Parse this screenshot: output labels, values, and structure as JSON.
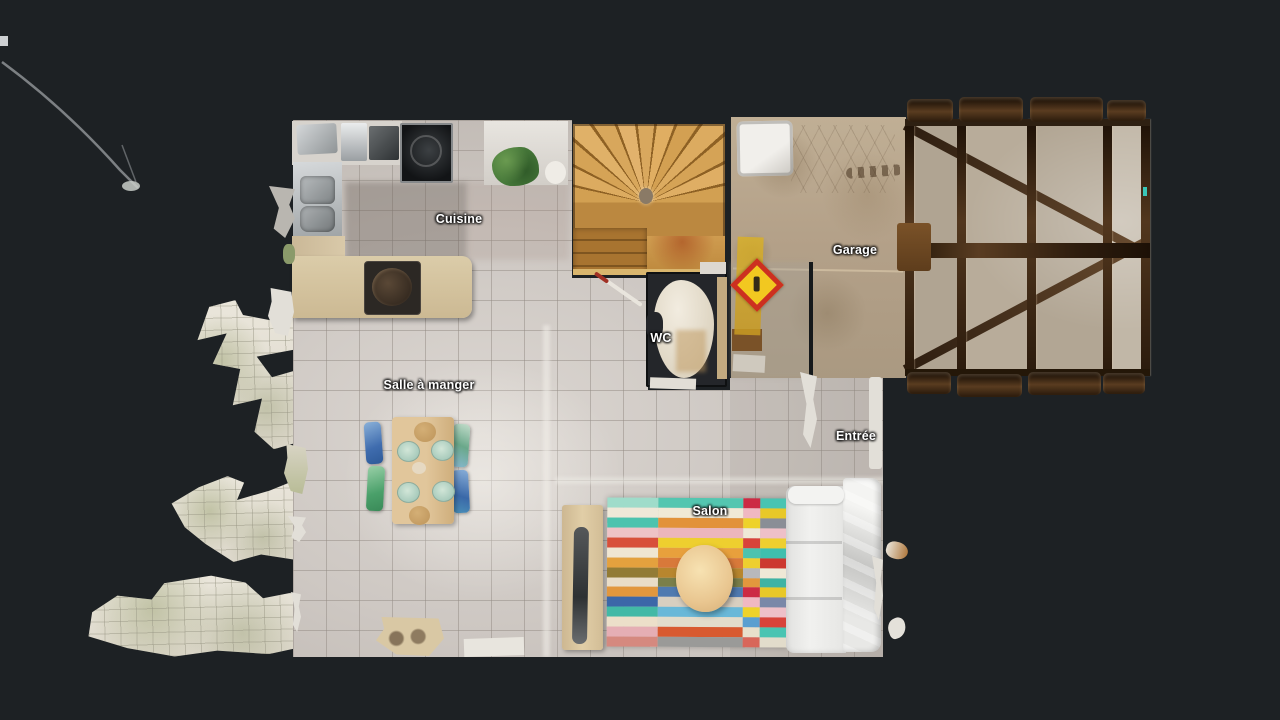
{
  "viewer": {
    "background_color": "#1d2124",
    "floor_tile_color": "#cec8c3",
    "stair_wood_color": "#d2a052",
    "garage_floor_color": "#b4a189",
    "roof_beam_color": "#3a2814",
    "warning_sign_colors": {
      "border": "#cc3020",
      "fill": "#f2c820"
    }
  },
  "floorplan": {
    "rooms": [
      {
        "id": "cuisine",
        "label": "Cuisine",
        "x": 459,
        "y": 219
      },
      {
        "id": "garage",
        "label": "Garage",
        "x": 855,
        "y": 250
      },
      {
        "id": "wc",
        "label": "WC",
        "x": 661,
        "y": 338
      },
      {
        "id": "salle-a-manger",
        "label": "Salle à manger",
        "x": 429,
        "y": 385
      },
      {
        "id": "entree",
        "label": "Entrée",
        "x": 856,
        "y": 436
      },
      {
        "id": "salon",
        "label": "Salon",
        "x": 710,
        "y": 511
      }
    ],
    "furniture": {
      "dining_plate_color": "#a9cbbc",
      "dining_table_color": "#dcc096",
      "chair_colors": [
        "#3f6cae",
        "#4aa06a",
        "#6aa88a",
        "#3a68a8"
      ],
      "couch_color": "#ededeb",
      "coffee_table_color": "#e9c690"
    },
    "rug": {
      "x": 607,
      "y": 498,
      "width": 181,
      "height": 149,
      "columns": [
        {
          "x": 0,
          "w": 51,
          "stripes": [
            "#9fdcca",
            "#efe8d8",
            "#4cc3ae",
            "#eec3c6",
            "#d8503a",
            "#efe6d2",
            "#e4a13e",
            "#927b35",
            "#e9ddc8",
            "#e2973d",
            "#3c67a8",
            "#42b9a6",
            "#ecdfc9",
            "#e5aeb4",
            "#d5897f"
          ]
        },
        {
          "x": 51,
          "w": 85,
          "stripes": [
            "#54c6b0",
            "#f0e9d6",
            "#e2923a",
            "#ecb6bc",
            "#eecf2f",
            "#e8a03c",
            "#d8793a",
            "#b8862e",
            "#7a7f4a",
            "#4f7ab0",
            "#d8cfc0",
            "#69b8d8",
            "#e2dccb",
            "#d85a30",
            "#9a9a98"
          ]
        },
        {
          "x": 136,
          "w": 17,
          "stripes": [
            "#cc2b44",
            "#f0b8c2",
            "#eed22a",
            "#efe8d6",
            "#d8433a",
            "#4cc3ae",
            "#eecf2f",
            "#b8b8bc",
            "#e2973d",
            "#cc2b44",
            "#f0b8c2",
            "#eed22a",
            "#5a9fd0",
            "#e8e0cc",
            "#d8665a"
          ]
        },
        {
          "x": 153,
          "w": 28,
          "stripes": [
            "#49c4b2",
            "#e8c828",
            "#8a8e96",
            "#eec0c8",
            "#eecf2f",
            "#3fbfae",
            "#cc3830",
            "#efe8d6",
            "#3fb3a4",
            "#e8c828",
            "#7a88a8",
            "#eec0c8",
            "#d8433a",
            "#49c4b2",
            "#e2dccb"
          ]
        }
      ]
    }
  }
}
